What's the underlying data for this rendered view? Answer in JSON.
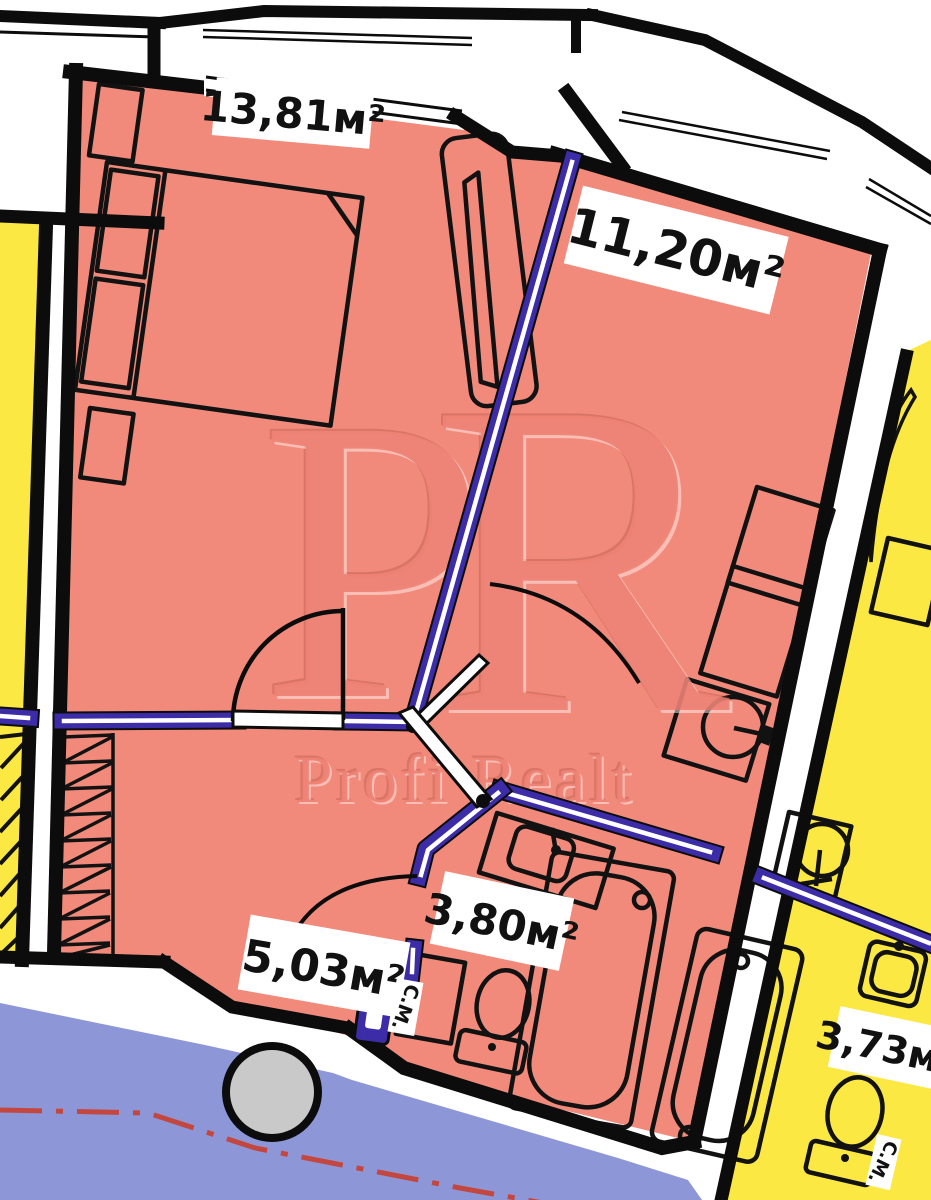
{
  "plan_title": "apartment-floor-plan",
  "watermark": {
    "initial_p": "P",
    "initial_r": "R",
    "brand": "Profi Realt"
  },
  "rooms": [
    {
      "name": "bedroom",
      "area": "13,81м²"
    },
    {
      "name": "living-kitchen",
      "area": "11,20м²"
    },
    {
      "name": "bathroom",
      "area": "3,80м²"
    },
    {
      "name": "hallway",
      "area": "5,03м²"
    },
    {
      "name": "adjacent-bathroom",
      "area": "3,73м²"
    }
  ],
  "labels": {
    "washing_machine": "С.М."
  },
  "colors": {
    "apartment_fill": "#f28a7b",
    "neighbor_fill": "#fbe843",
    "corridor_fill": "#8d97d8",
    "wall": "#0c0c0c",
    "partition": "#3c2ca7",
    "watermark": "#e97f6f",
    "axis_line": "#c4473f",
    "column": "#c9c9c9"
  }
}
